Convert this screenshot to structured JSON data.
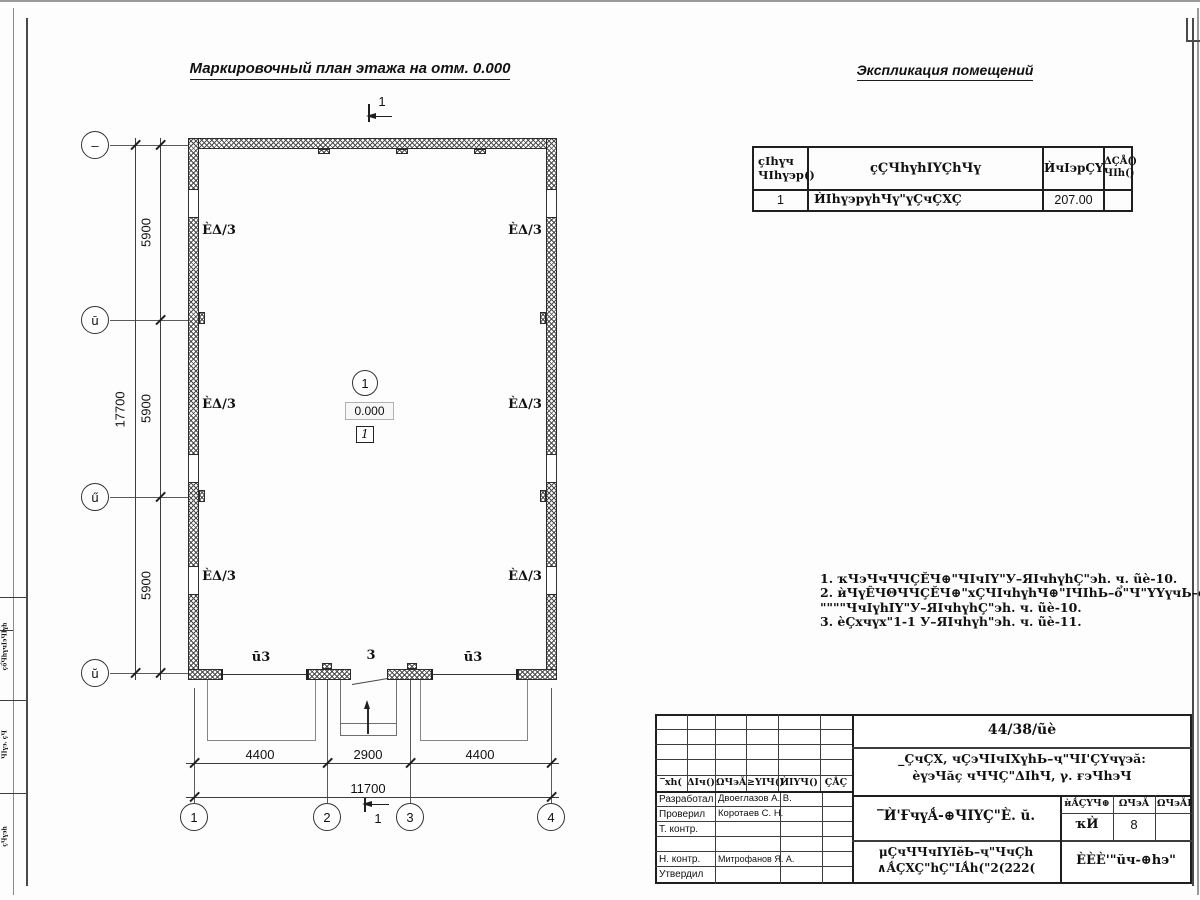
{
  "titles": {
    "plan": "Маркировочный план этажа на отм. 0.000",
    "explication": "Экспликация помещений"
  },
  "plan": {
    "room_mark": "ÈΔ/3",
    "door_marks": {
      "left": "ū3",
      "center": "3",
      "right": "ū3"
    },
    "center": {
      "axis_circle": "1",
      "level": "0.000",
      "room_tag": "1"
    },
    "section": {
      "top": "1",
      "bottom": "1"
    },
    "axes_bottom": [
      "1",
      "2",
      "3",
      "4"
    ],
    "axes_left": [
      "–",
      "ū",
      "ű",
      "ŭ"
    ],
    "dims": {
      "bottom": [
        "4400",
        "2900",
        "4400"
      ],
      "bottom_total": "11700",
      "left": [
        "5900",
        "5900",
        "5900"
      ],
      "left_total": "17700"
    }
  },
  "explication": {
    "header": {
      "num1": "ҫIhүч",
      "num2": "ЧIhү϶р()",
      "name": "ҫÇЧhүhIYÇhЧү",
      "area": "ЍчI϶рÇY-",
      "note1": "ΔÇÅ()",
      "note2": "ЧIh()"
    },
    "row": {
      "num": "1",
      "name": "ЍIhү϶рүhЧү\"үÇчÇXÇ",
      "area": "207.00",
      "note": ""
    }
  },
  "notes": [
    "1. ҡЧ϶ЧчЧЧÇĔЧ⊕\"ЧIчIY\"У–ЯIчhүhÇ\"϶h. ч. ũè-10.",
    "2. ѝЧүÊЧΘЧЧÇĔЧ⊕\"хÇЧIчhүhЧ⊕\"IЧIhЬ–ổ\"Ч\"YYүчЬ–ổ",
    "\"\"\"\"ЧчIүhIY\"У–ЯIчhүhÇ\"϶h. ч. ũè-10.",
    "3. ѐÇхчүх\"1-1 У–ЯIчhүh\"϶h. ч. ũè-11."
  ],
  "title_block": {
    "code": "44/38/ũè",
    "object1": "_ÇчÇX, чÇ϶ЧIчIXүhЬ–ҷ\"ЧI'ÇYчү϶ă:",
    "object2": "ѐү϶Чăҫ чЧЧÇ\"ΔIhЧ, γ. ғ϶Чh϶Ч",
    "sheet_name": "‾Ѝ'ҒчүǺ-⊕ЧIYÇ\"È. ŭ.",
    "doc1": "μÇчЧЧчIYIĕЬ–ҷ\"ЧчÇh",
    "doc2": "∧ǺÇXÇ\"hÇ\"IǺh(\"2(222(",
    "company": "ÈÈÈ'\"ŭч-⊕h϶\"",
    "stage": {
      "h1": "ѝǺÇYЧ⊕",
      "h2": "ΩЧ϶Ă",
      "h3": "ΩЧ϶ĂI",
      "v1": "ҡЍ",
      "v2": "8"
    },
    "header_cols": [
      "‾хh(",
      "ΔIч()",
      "ΩЧ϶Ă",
      "≥YIЧ()",
      "ЍIYЧ()",
      "ÇÅÇ"
    ],
    "rows": [
      {
        "role": "Разработал",
        "name": "Двоеглазов А. В."
      },
      {
        "role": "Проверил",
        "name": "Коротаев С. Н."
      },
      {
        "role": "Т. контр.",
        "name": ""
      },
      {
        "role": "",
        "name": ""
      },
      {
        "role": "Н. контр.",
        "name": "Митрофанов Я. А."
      },
      {
        "role": "Утвердил",
        "name": ""
      }
    ]
  },
  "left_strip": [
    "ҫổЧhүчI϶ЧIүh",
    "ЧIү϶. ҫЧ",
    "ҫЧү϶h"
  ]
}
